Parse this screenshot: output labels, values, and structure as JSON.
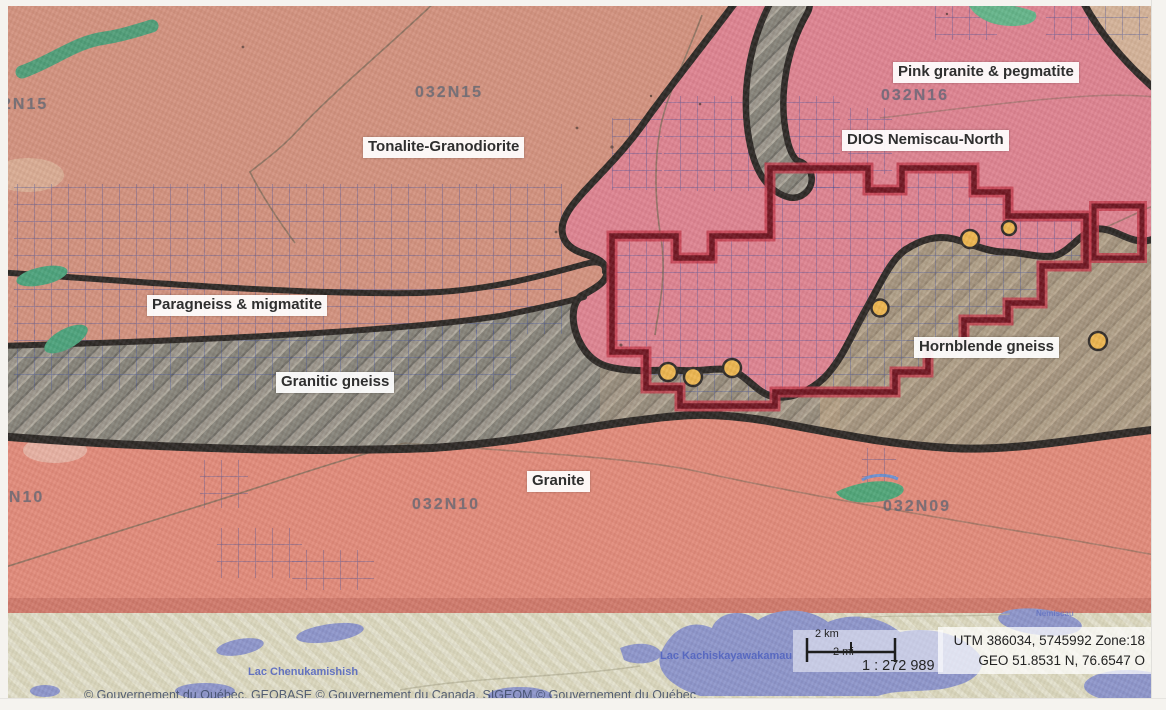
{
  "title": "Geological map - DIOS Nemiscau-North property",
  "region_labels": [
    {
      "id": "tonalite",
      "text": "Tonalite-Granodiorite"
    },
    {
      "id": "pink-granite",
      "text": "Pink granite & pegmatite"
    },
    {
      "id": "property",
      "text": "DIOS Nemiscau-North"
    },
    {
      "id": "paragneiss",
      "text": "Paragneiss & migmatite"
    },
    {
      "id": "granitic-gneiss",
      "text": "Granitic gneiss"
    },
    {
      "id": "hornblende",
      "text": "Hornblende gneiss"
    },
    {
      "id": "granite",
      "text": "Granite"
    }
  ],
  "sheet_labels": [
    {
      "id": "nts-2N15",
      "text": "2N15"
    },
    {
      "id": "nts-032N15",
      "text": "032N15"
    },
    {
      "id": "nts-032N16",
      "text": "032N16"
    },
    {
      "id": "nts-2N10",
      "text": "2N10"
    },
    {
      "id": "nts-032N10",
      "text": "032N10"
    },
    {
      "id": "nts-032N09",
      "text": "032N09"
    }
  ],
  "lakes": [
    {
      "id": "chenukamishish",
      "text": "Lac Chenukamishish"
    },
    {
      "id": "kachiskayawakamau",
      "text": "Lac Kachiskayawakamau"
    },
    {
      "id": "nemiscau",
      "text": "Nemiscau"
    }
  ],
  "scalebar": {
    "km": "2 km",
    "mi": "2 mi",
    "ratio": "1 : 272 989"
  },
  "coordinates": {
    "utm": "UTM 386034, 5745992 Zone:18",
    "geo": "GEO 51.8531 N, 76.6547 O"
  },
  "attribution": "© Gouvernement du Québec, GEOBASE © Gouvernement du Canada, SIGEOM © Gouvernement du Québec",
  "markers": {
    "type": "sample-location-dot",
    "count": 7,
    "color": "#ecb54e"
  },
  "colors": {
    "tonalite_bg": "#d2917e",
    "pink_granite": "#dd8290",
    "granite": "#e18a7a",
    "gneiss_gray": "#9a958b",
    "hornblende_tint": "#c7a983",
    "claim_grid_blue": "#3b4c9a",
    "property_outline": "#6e1420",
    "property_halo": "#c23748",
    "boundary_black": "#2b2724",
    "green_unit": "#4aa27b",
    "basemap_strip": "#d9d6bc",
    "lake_blue": "#8c95cb"
  }
}
